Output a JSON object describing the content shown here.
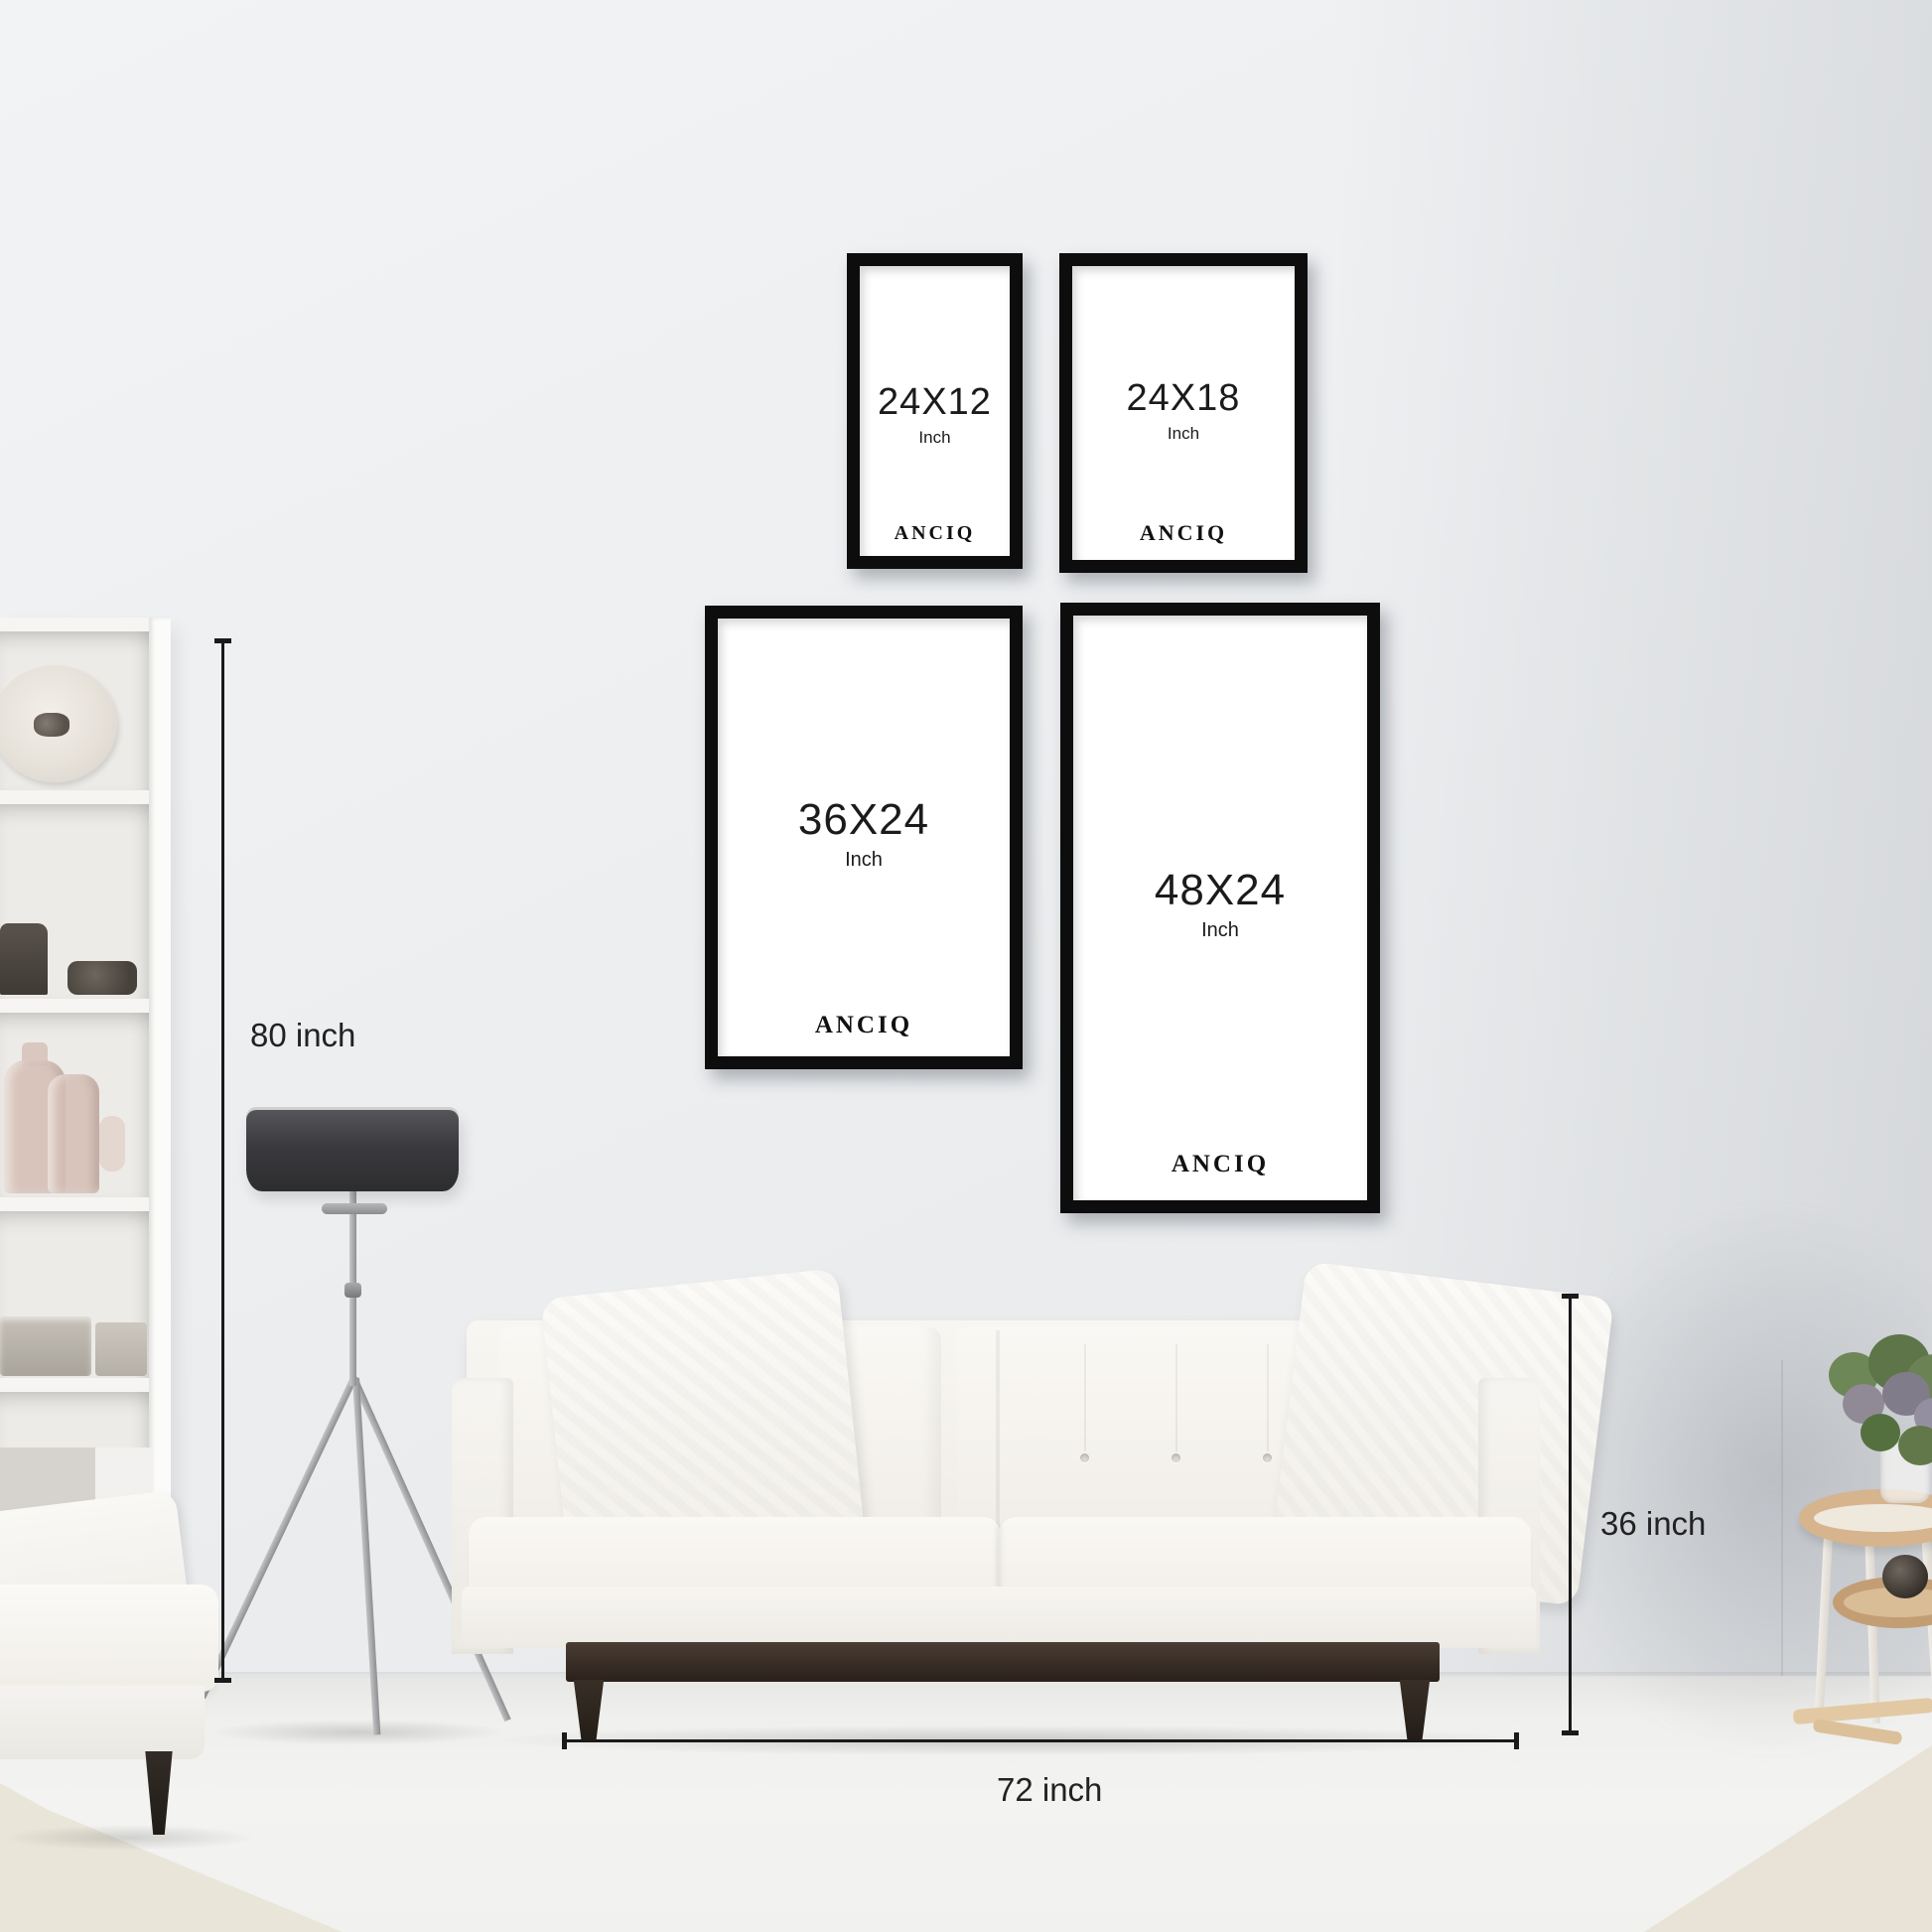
{
  "brand": "ANCIQ",
  "frames": [
    {
      "size": "24X12",
      "unit": "Inch",
      "brand": "ANCIQ"
    },
    {
      "size": "24X18",
      "unit": "Inch",
      "brand": "ANCIQ"
    },
    {
      "size": "36X24",
      "unit": "Inch",
      "brand": "ANCIQ"
    },
    {
      "size": "48X24",
      "unit": "Inch",
      "brand": "ANCIQ"
    }
  ],
  "measurements": {
    "wall_height": {
      "label": "80 inch"
    },
    "sofa_height": {
      "label": "36 inch"
    },
    "sofa_width": {
      "label": "72 inch"
    }
  },
  "colors": {
    "wall": "#edeff1",
    "floor": "#f1f1ef",
    "frame_border": "#0d0d0d",
    "frame_matte": "#ffffff",
    "measure_line": "#1a1a1a",
    "text": "#1b1b1b",
    "lamp_shade": "#3a3a3e",
    "sofa_fabric": "#f7f5f1",
    "sofa_wood": "#2a211b",
    "rug": "#e9e5d9"
  }
}
